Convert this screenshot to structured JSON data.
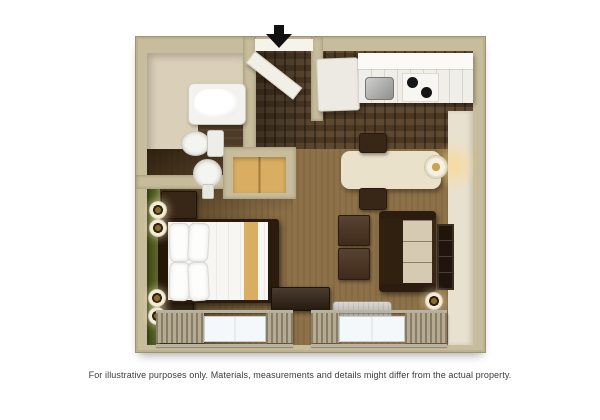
{
  "caption": {
    "text": "For illustrative purposes only.  Materials, measurements and details might differ from the actual property."
  },
  "icons": {
    "entrance_arrow": "▼ solid black arrow marking the unit entrance door"
  },
  "palette": {
    "background": "#ffffff",
    "wall": "#c7bc9b",
    "bath_floor": "#dacfb8",
    "dark_tile": "#4e3a27",
    "wood_floor": "#543e27",
    "carpet": "#8d7148",
    "accent_wall_green": "#4d5a1f",
    "closet_wood": "#d9ae62",
    "counter_white": "#efeee8",
    "appliance_white": "#eceae3",
    "table_cream": "#e9e1ca",
    "sofa_frame": "#3a2817",
    "sofa_cushion": "#d6cab2",
    "furniture_dark": "#382717",
    "window_glass": "#f4f8fa",
    "curtain": "#9a9079",
    "ac_unit": "#b7b2aa",
    "right_floor": "#e9e1cf",
    "arrow_black": "#111111",
    "caption_text": "#3b3b3b"
  },
  "regions": [
    {
      "id": "bathroom",
      "features": [
        "bathtub",
        "toilet",
        "pedestal-sink",
        "dark-tile-floor"
      ]
    },
    {
      "id": "entry-hall",
      "features": [
        "entrance-door",
        "dark-wood-floor"
      ]
    },
    {
      "id": "kitchen",
      "features": [
        "refrigerator",
        "counter",
        "kitchen-sink",
        "two-burner-stove",
        "cabinets"
      ]
    },
    {
      "id": "dining-area",
      "features": [
        "table",
        "table-lamp",
        "two-chairs"
      ]
    },
    {
      "id": "living-area",
      "features": [
        "sofa",
        "two-ottomans",
        "wall-tv-panel",
        "wall-sconce",
        "ac-unit"
      ]
    },
    {
      "id": "bedroom",
      "features": [
        "queen-bed",
        "green-accent-wall",
        "four-wall-sconces",
        "two-nightstands",
        "closet",
        "media-dresser"
      ]
    },
    {
      "id": "windows",
      "features": [
        "left-window",
        "right-window",
        "curtains"
      ]
    }
  ]
}
